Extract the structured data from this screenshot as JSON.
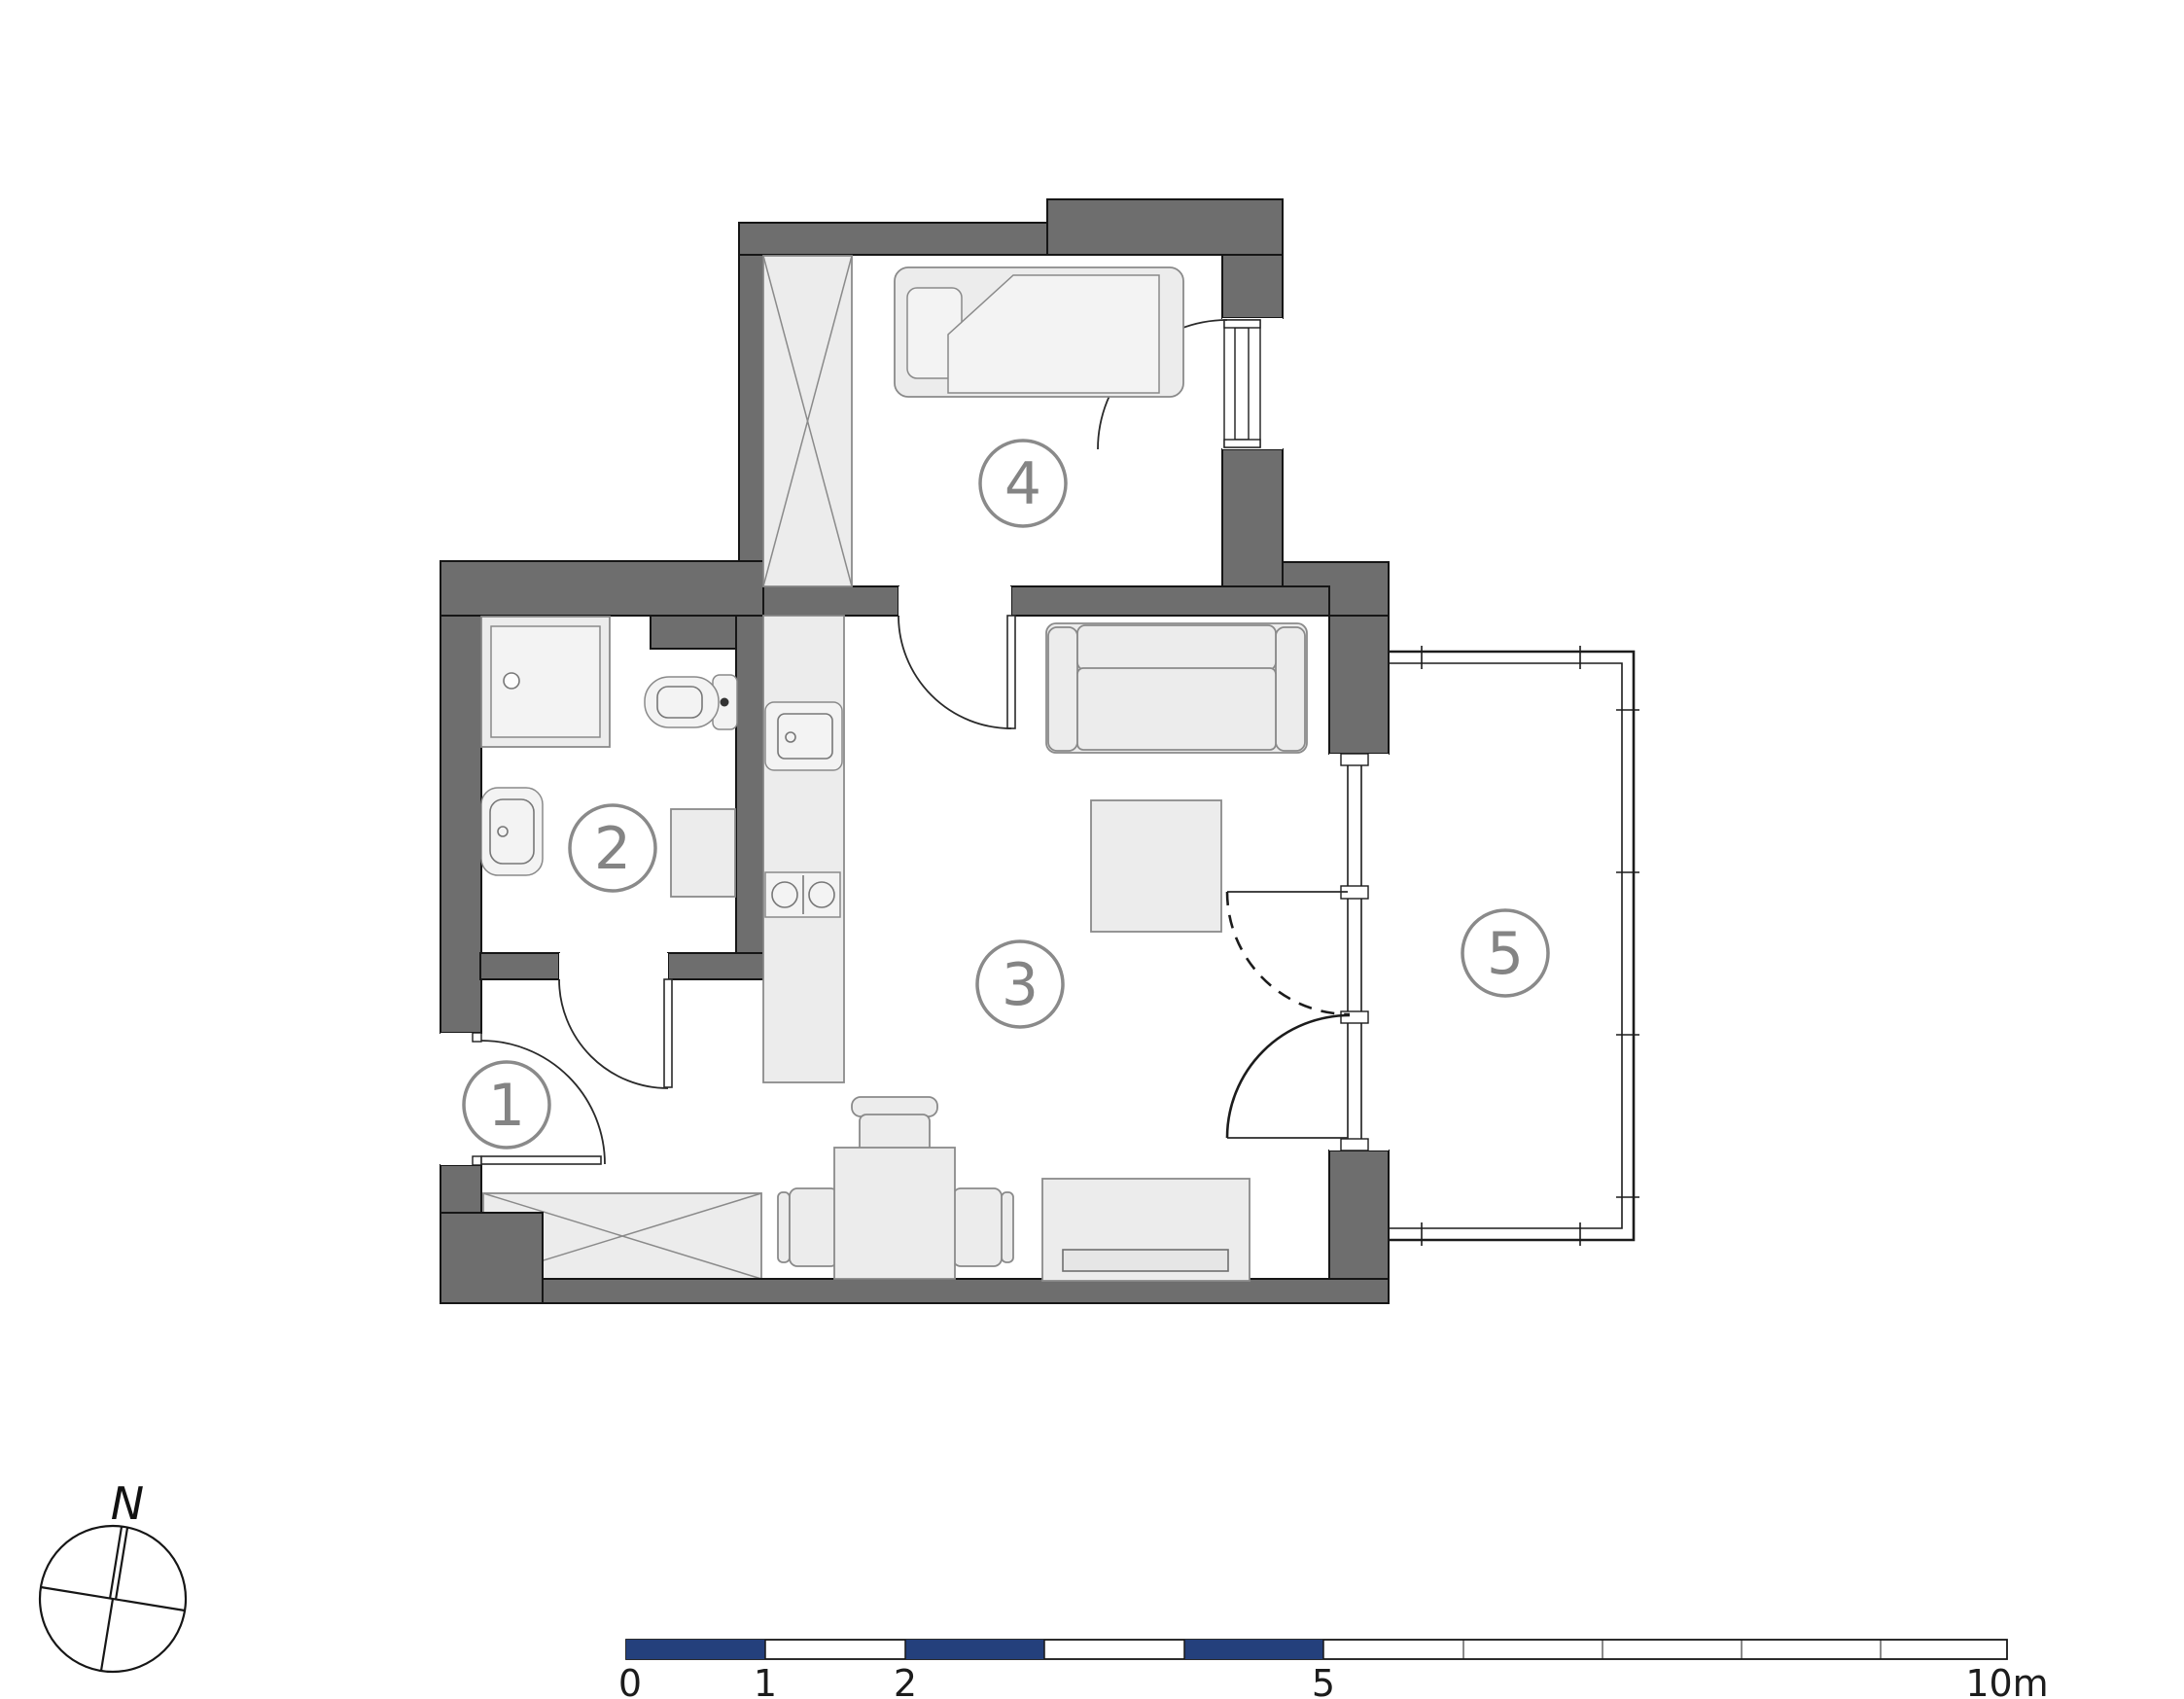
{
  "plan": {
    "kind": "apartment-floor-plan",
    "rooms": [
      {
        "number": "1",
        "name": "hallway"
      },
      {
        "number": "2",
        "name": "bathroom"
      },
      {
        "number": "3",
        "name": "living-room-with-kitchenette"
      },
      {
        "number": "4",
        "name": "bedroom"
      },
      {
        "number": "5",
        "name": "balcony"
      }
    ],
    "furniture": [
      "wardrobe",
      "bed",
      "sofa",
      "coffee-table",
      "tv-cabinet",
      "dining-table",
      "chairs",
      "kitchen-counter",
      "kitchen-sink",
      "cooktop",
      "shower",
      "toilet",
      "washbasin",
      "washing-machine",
      "hall-wardrobe"
    ]
  },
  "compass": {
    "label": "N"
  },
  "scale_bar": {
    "unit": "m",
    "labels": [
      "0",
      "1",
      "2",
      "5",
      "10m"
    ],
    "tick_values_m": [
      0,
      1,
      2,
      5,
      10
    ],
    "filled_segments_m": [
      [
        0,
        1
      ],
      [
        2,
        3
      ],
      [
        4,
        5
      ]
    ]
  },
  "colors": {
    "wall": "#6e6e6e",
    "furniture_fill": "#ececec",
    "scale_fill": "#24407c",
    "label_gray": "#848484",
    "background": "#ffffff"
  }
}
